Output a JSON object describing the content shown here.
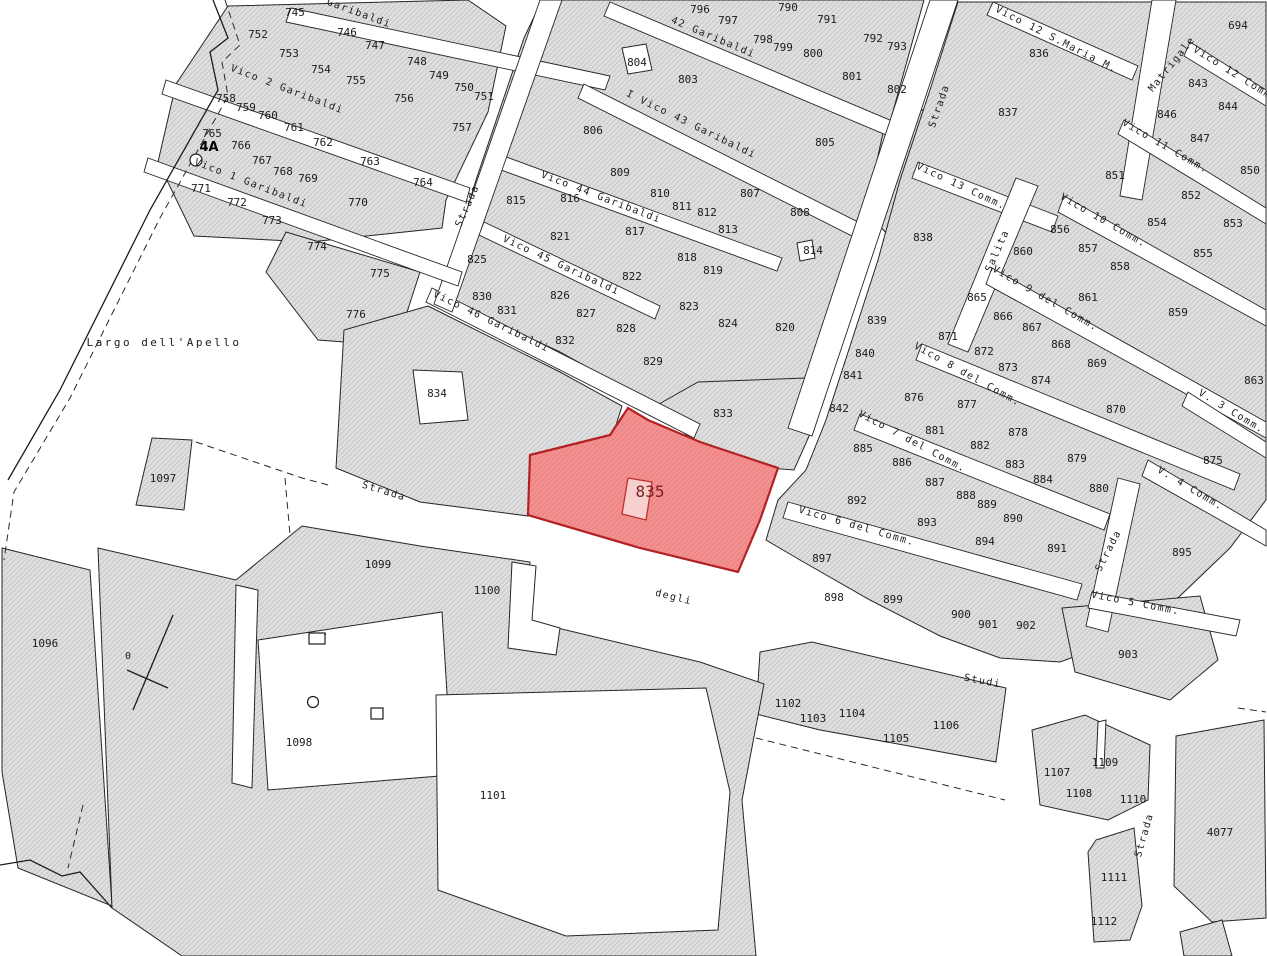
{
  "map": {
    "title": "cadastral-parcel-map",
    "highlighted_parcel": "835",
    "colors": {
      "background": "#ffffff",
      "parcel_fill": "#e0e0e0",
      "parcel_hatch_line": "#c6c6c6",
      "parcel_stroke": "#262626",
      "highlight_fill": "#f28585",
      "highlight_hatch_line": "#ee9d9d",
      "highlight_stroke": "#b22222",
      "highlight_label": "#7e1f1f",
      "label_color": "#1c1c1c"
    }
  },
  "parcels": [
    {
      "n": "745",
      "x": 295,
      "y": 12
    },
    {
      "n": "746",
      "x": 347,
      "y": 32
    },
    {
      "n": "747",
      "x": 375,
      "y": 45
    },
    {
      "n": "748",
      "x": 417,
      "y": 61
    },
    {
      "n": "749",
      "x": 439,
      "y": 75
    },
    {
      "n": "750",
      "x": 464,
      "y": 87
    },
    {
      "n": "751",
      "x": 484,
      "y": 96
    },
    {
      "n": "752",
      "x": 258,
      "y": 34
    },
    {
      "n": "753",
      "x": 289,
      "y": 53
    },
    {
      "n": "754",
      "x": 321,
      "y": 69
    },
    {
      "n": "755",
      "x": 356,
      "y": 80
    },
    {
      "n": "756",
      "x": 404,
      "y": 98
    },
    {
      "n": "757",
      "x": 462,
      "y": 127
    },
    {
      "n": "758",
      "x": 226,
      "y": 98
    },
    {
      "n": "759",
      "x": 246,
      "y": 107
    },
    {
      "n": "760",
      "x": 268,
      "y": 115
    },
    {
      "n": "761",
      "x": 294,
      "y": 127
    },
    {
      "n": "762",
      "x": 323,
      "y": 142
    },
    {
      "n": "763",
      "x": 370,
      "y": 161
    },
    {
      "n": "764",
      "x": 423,
      "y": 182
    },
    {
      "n": "765",
      "x": 212,
      "y": 133
    },
    {
      "n": "766",
      "x": 241,
      "y": 145
    },
    {
      "n": "767",
      "x": 262,
      "y": 160
    },
    {
      "n": "768",
      "x": 283,
      "y": 171
    },
    {
      "n": "769",
      "x": 308,
      "y": 178
    },
    {
      "n": "770",
      "x": 358,
      "y": 202
    },
    {
      "n": "771",
      "x": 201,
      "y": 188
    },
    {
      "n": "772",
      "x": 237,
      "y": 202
    },
    {
      "n": "773",
      "x": 272,
      "y": 220
    },
    {
      "n": "774",
      "x": 317,
      "y": 246
    },
    {
      "n": "775",
      "x": 380,
      "y": 273
    },
    {
      "n": "776",
      "x": 356,
      "y": 314
    },
    {
      "n": "790",
      "x": 788,
      "y": 7
    },
    {
      "n": "791",
      "x": 827,
      "y": 19
    },
    {
      "n": "792",
      "x": 873,
      "y": 38
    },
    {
      "n": "793",
      "x": 897,
      "y": 46
    },
    {
      "n": "796",
      "x": 700,
      "y": 9
    },
    {
      "n": "797",
      "x": 728,
      "y": 20
    },
    {
      "n": "798",
      "x": 763,
      "y": 39
    },
    {
      "n": "799",
      "x": 783,
      "y": 47
    },
    {
      "n": "800",
      "x": 813,
      "y": 53
    },
    {
      "n": "801",
      "x": 852,
      "y": 76
    },
    {
      "n": "802",
      "x": 897,
      "y": 89
    },
    {
      "n": "803",
      "x": 688,
      "y": 79
    },
    {
      "n": "804",
      "x": 637,
      "y": 62
    },
    {
      "n": "805",
      "x": 825,
      "y": 142
    },
    {
      "n": "806",
      "x": 593,
      "y": 130
    },
    {
      "n": "807",
      "x": 750,
      "y": 193
    },
    {
      "n": "808",
      "x": 800,
      "y": 212
    },
    {
      "n": "809",
      "x": 620,
      "y": 172
    },
    {
      "n": "810",
      "x": 660,
      "y": 193
    },
    {
      "n": "811",
      "x": 682,
      "y": 206
    },
    {
      "n": "812",
      "x": 707,
      "y": 212
    },
    {
      "n": "813",
      "x": 728,
      "y": 229
    },
    {
      "n": "814",
      "x": 813,
      "y": 250
    },
    {
      "n": "815",
      "x": 516,
      "y": 200
    },
    {
      "n": "816",
      "x": 570,
      "y": 198
    },
    {
      "n": "817",
      "x": 635,
      "y": 231
    },
    {
      "n": "818",
      "x": 687,
      "y": 257
    },
    {
      "n": "819",
      "x": 713,
      "y": 270
    },
    {
      "n": "820",
      "x": 785,
      "y": 327
    },
    {
      "n": "821",
      "x": 560,
      "y": 236
    },
    {
      "n": "822",
      "x": 632,
      "y": 276
    },
    {
      "n": "823",
      "x": 689,
      "y": 306
    },
    {
      "n": "824",
      "x": 728,
      "y": 323
    },
    {
      "n": "825",
      "x": 477,
      "y": 259
    },
    {
      "n": "826",
      "x": 560,
      "y": 295
    },
    {
      "n": "827",
      "x": 586,
      "y": 313
    },
    {
      "n": "828",
      "x": 626,
      "y": 328
    },
    {
      "n": "829",
      "x": 653,
      "y": 361
    },
    {
      "n": "830",
      "x": 482,
      "y": 296
    },
    {
      "n": "831",
      "x": 507,
      "y": 310
    },
    {
      "n": "832",
      "x": 565,
      "y": 340
    },
    {
      "n": "833",
      "x": 723,
      "y": 413
    },
    {
      "n": "834",
      "x": 437,
      "y": 393
    },
    {
      "n": "836",
      "x": 1039,
      "y": 53
    },
    {
      "n": "837",
      "x": 1008,
      "y": 112
    },
    {
      "n": "838",
      "x": 923,
      "y": 237
    },
    {
      "n": "839",
      "x": 877,
      "y": 320
    },
    {
      "n": "840",
      "x": 865,
      "y": 353
    },
    {
      "n": "841",
      "x": 853,
      "y": 375
    },
    {
      "n": "842",
      "x": 839,
      "y": 408
    },
    {
      "n": "843",
      "x": 1198,
      "y": 83
    },
    {
      "n": "844",
      "x": 1228,
      "y": 106
    },
    {
      "n": "846",
      "x": 1167,
      "y": 114
    },
    {
      "n": "847",
      "x": 1200,
      "y": 138
    },
    {
      "n": "850",
      "x": 1250,
      "y": 170
    },
    {
      "n": "851",
      "x": 1115,
      "y": 175
    },
    {
      "n": "852",
      "x": 1191,
      "y": 195
    },
    {
      "n": "853",
      "x": 1233,
      "y": 223
    },
    {
      "n": "854",
      "x": 1157,
      "y": 222
    },
    {
      "n": "855",
      "x": 1203,
      "y": 253
    },
    {
      "n": "856",
      "x": 1060,
      "y": 229
    },
    {
      "n": "857",
      "x": 1088,
      "y": 248
    },
    {
      "n": "858",
      "x": 1120,
      "y": 266
    },
    {
      "n": "859",
      "x": 1178,
      "y": 312
    },
    {
      "n": "860",
      "x": 1023,
      "y": 251
    },
    {
      "n": "861",
      "x": 1088,
      "y": 297
    },
    {
      "n": "863",
      "x": 1254,
      "y": 380
    },
    {
      "n": "865",
      "x": 977,
      "y": 297
    },
    {
      "n": "866",
      "x": 1003,
      "y": 316
    },
    {
      "n": "867",
      "x": 1032,
      "y": 327
    },
    {
      "n": "868",
      "x": 1061,
      "y": 344
    },
    {
      "n": "869",
      "x": 1097,
      "y": 363
    },
    {
      "n": "870",
      "x": 1116,
      "y": 409
    },
    {
      "n": "871",
      "x": 948,
      "y": 336
    },
    {
      "n": "872",
      "x": 984,
      "y": 351
    },
    {
      "n": "873",
      "x": 1008,
      "y": 367
    },
    {
      "n": "874",
      "x": 1041,
      "y": 380
    },
    {
      "n": "875",
      "x": 1213,
      "y": 460
    },
    {
      "n": "876",
      "x": 914,
      "y": 397
    },
    {
      "n": "877",
      "x": 967,
      "y": 404
    },
    {
      "n": "878",
      "x": 1018,
      "y": 432
    },
    {
      "n": "879",
      "x": 1077,
      "y": 458
    },
    {
      "n": "880",
      "x": 1099,
      "y": 488
    },
    {
      "n": "881",
      "x": 935,
      "y": 430
    },
    {
      "n": "882",
      "x": 980,
      "y": 445
    },
    {
      "n": "883",
      "x": 1015,
      "y": 464
    },
    {
      "n": "884",
      "x": 1043,
      "y": 479
    },
    {
      "n": "885",
      "x": 863,
      "y": 448
    },
    {
      "n": "886",
      "x": 902,
      "y": 462
    },
    {
      "n": "887",
      "x": 935,
      "y": 482
    },
    {
      "n": "888",
      "x": 966,
      "y": 495
    },
    {
      "n": "889",
      "x": 987,
      "y": 504
    },
    {
      "n": "890",
      "x": 1013,
      "y": 518
    },
    {
      "n": "891",
      "x": 1057,
      "y": 548
    },
    {
      "n": "892",
      "x": 857,
      "y": 500
    },
    {
      "n": "893",
      "x": 927,
      "y": 522
    },
    {
      "n": "894",
      "x": 985,
      "y": 541
    },
    {
      "n": "895",
      "x": 1182,
      "y": 552
    },
    {
      "n": "897",
      "x": 822,
      "y": 558
    },
    {
      "n": "898",
      "x": 834,
      "y": 597
    },
    {
      "n": "899",
      "x": 893,
      "y": 599
    },
    {
      "n": "900",
      "x": 961,
      "y": 614
    },
    {
      "n": "901",
      "x": 988,
      "y": 624
    },
    {
      "n": "902",
      "x": 1026,
      "y": 625
    },
    {
      "n": "903",
      "x": 1128,
      "y": 654
    },
    {
      "n": "694",
      "x": 1238,
      "y": 25
    },
    {
      "n": "1096",
      "x": 45,
      "y": 643
    },
    {
      "n": "1097",
      "x": 163,
      "y": 478
    },
    {
      "n": "1098",
      "x": 299,
      "y": 742
    },
    {
      "n": "1099",
      "x": 378,
      "y": 564
    },
    {
      "n": "1100",
      "x": 487,
      "y": 590
    },
    {
      "n": "1101",
      "x": 493,
      "y": 795
    },
    {
      "n": "1102",
      "x": 788,
      "y": 703
    },
    {
      "n": "1103",
      "x": 813,
      "y": 718
    },
    {
      "n": "1104",
      "x": 852,
      "y": 713
    },
    {
      "n": "1105",
      "x": 896,
      "y": 738
    },
    {
      "n": "1106",
      "x": 946,
      "y": 725
    },
    {
      "n": "1107",
      "x": 1057,
      "y": 772
    },
    {
      "n": "1108",
      "x": 1079,
      "y": 793
    },
    {
      "n": "1109",
      "x": 1105,
      "y": 762
    },
    {
      "n": "1110",
      "x": 1133,
      "y": 799
    },
    {
      "n": "1111",
      "x": 1114,
      "y": 877
    },
    {
      "n": "1112",
      "x": 1104,
      "y": 921
    },
    {
      "n": "4077",
      "x": 1220,
      "y": 832
    }
  ],
  "highlight_label": {
    "n": "835",
    "x": 650,
    "y": 497
  },
  "street_labels": [
    {
      "t": "Garibaldi",
      "x": 358,
      "y": 16,
      "a": 20
    },
    {
      "t": "Vico 2 Garibaldi",
      "x": 286,
      "y": 92,
      "a": 21
    },
    {
      "t": "Vico 1 Garibaldi",
      "x": 250,
      "y": 186,
      "a": 21
    },
    {
      "t": "Strada",
      "x": 470,
      "y": 207,
      "a": -66
    },
    {
      "t": "42  Garibaldi",
      "x": 712,
      "y": 40,
      "a": 23
    },
    {
      "t": "I Vico 43 Garibaldi",
      "x": 690,
      "y": 127,
      "a": 26
    },
    {
      "t": "Vico 44 Garibaldi",
      "x": 600,
      "y": 200,
      "a": 21
    },
    {
      "t": "Vico 45 Garibaldi",
      "x": 560,
      "y": 268,
      "a": 25
    },
    {
      "t": "Vico 46 Garibaldi",
      "x": 490,
      "y": 324,
      "a": 26
    },
    {
      "t": "Strada",
      "x": 383,
      "y": 494,
      "a": 17
    },
    {
      "t": "degli",
      "x": 673,
      "y": 600,
      "a": 14
    },
    {
      "t": "Studi",
      "x": 982,
      "y": 684,
      "a": 11
    },
    {
      "t": "Vico 12 S.Maria M.",
      "x": 1055,
      "y": 42,
      "a": 27
    },
    {
      "t": "Matrigale",
      "x": 1174,
      "y": 66,
      "a": -51
    },
    {
      "t": "Vico 12 Comm.",
      "x": 1234,
      "y": 77,
      "a": 32
    },
    {
      "t": "Vico 11 Comm.",
      "x": 1164,
      "y": 149,
      "a": 30
    },
    {
      "t": "Vico 13 Comm.",
      "x": 960,
      "y": 189,
      "a": 25
    },
    {
      "t": "Vico 10 Comm.",
      "x": 1102,
      "y": 223,
      "a": 30
    },
    {
      "t": "Strada",
      "x": 942,
      "y": 107,
      "a": -71
    },
    {
      "t": "Salita",
      "x": 1000,
      "y": 252,
      "a": -66
    },
    {
      "t": "Vico 9 del Comm.",
      "x": 1044,
      "y": 301,
      "a": 30
    },
    {
      "t": "Vico 8 del Comm.",
      "x": 966,
      "y": 377,
      "a": 29
    },
    {
      "t": "Vico 7 del Comm.",
      "x": 911,
      "y": 444,
      "a": 28
    },
    {
      "t": "Vico 6 del Comm.",
      "x": 856,
      "y": 529,
      "a": 16
    },
    {
      "t": "V. 3 Comm.",
      "x": 1230,
      "y": 414,
      "a": 31
    },
    {
      "t": "V. 4 Comm.",
      "x": 1189,
      "y": 491,
      "a": 31
    },
    {
      "t": "Strada",
      "x": 1111,
      "y": 552,
      "a": -63
    },
    {
      "t": "Vico 5 Comm.",
      "x": 1135,
      "y": 606,
      "a": 11
    },
    {
      "t": "Strada",
      "x": 1147,
      "y": 836,
      "a": -74
    }
  ],
  "place_labels": [
    {
      "t": "Largo dell'Apello",
      "x": 164,
      "y": 346,
      "cls": "place"
    },
    {
      "t": "4A",
      "x": 209,
      "y": 151,
      "cls": "marker"
    },
    {
      "t": "0",
      "x": 128,
      "y": 659,
      "cls": "tiny"
    }
  ],
  "geometry": {
    "blocks": [
      "228,6 468,0 506,26 488,112 446,200 442,228 310,242 194,236 158,162 176,84",
      "286,232 420,272 396,346 318,340 266,272",
      "542,0 924,0 806,424 778,454 700,430 560,352 444,298 458,240 476,180 524,38",
      "428,306 560,372 622,406 612,438 532,458 528,516 420,502 336,468 344,330",
      "652,408 698,382 806,378 818,416 794,470 742,466 688,436",
      "884,128 952,96 1002,200 988,262 920,268 866,212",
      "958,2 1266,2 1266,500 1230,548 1180,596 1120,640 1060,662 1000,658 940,636 870,600 800,560 766,540 778,500 806,470 826,420 852,340 878,260 900,180 930,90",
      "1062,608 1200,596 1218,660 1170,700 1075,672",
      "1032,730 1085,715 1150,745 1148,800 1108,820 1040,805",
      "1096,840 1134,828 1142,906 1130,940 1094,942 1088,852",
      "1176,736 1264,720 1266,918 1212,922 1174,886",
      "1180,932 1222,920 1232,956 1184,956",
      "760,652 812,642 1006,688 996,762 898,744 820,730 756,714",
      "2,548 90,570 112,906 18,868 2,772",
      "152,438 192,440 184,510 136,505",
      "98,548 236,580 302,526 420,546 530,562 524,620 700,662 764,684 742,800 756,956 182,956 112,908"
    ],
    "holes": [
      "258,640 442,612 452,775 268,790",
      "236,585 258,590 252,788 232,783",
      "512,562 536,566 532,620 560,628 556,655 508,648",
      "436,695 706,688 730,792 718,930 566,936 438,890",
      "413,370 462,372 468,420 420,424",
      "622,48 646,44 652,70 628,74",
      "797,243 812,240 815,258 800,261",
      "1098,722 1106,720 1104,768 1096,768"
    ],
    "streets": [
      "291,8 610,76 605,90 286,22",
      "610,2 904,126 898,140 604,16",
      "584,84 862,224 856,238 578,98",
      "498,154 782,258 777,271 493,167",
      "484,222 660,306 655,319 479,235",
      "432,288 700,424 694,438 426,302",
      "540,0 562,0 452,312 434,304",
      "166,80 470,188 466,202 162,94",
      "148,158 462,272 458,286 144,172",
      "930,0 958,0 812,436 788,428",
      "993,2 1138,66 1132,80 987,15",
      "1152,0 1176,0 1142,200 1120,196",
      "1190,42 1266,90 1266,106 1184,56",
      "1124,120 1266,208 1266,224 1118,134",
      "918,162 1058,216 1052,232 912,178",
      "1064,196 1266,310 1266,326 1058,212",
      "1016,178 1038,186 968,352 948,344",
      "992,268 1266,422 1266,438 986,284",
      "922,344 1240,474 1234,490 916,360",
      "860,414 1110,514 1104,530 854,430",
      "1188,392 1266,442 1266,458 1182,406",
      "1148,460 1266,530 1266,546 1142,476",
      "1118,478 1140,484 1108,632 1086,626",
      "788,502 1082,584 1077,600 783,518",
      "1092,592 1240,620 1236,636 1088,608"
    ],
    "highlight": "530,455 610,435 628,408 648,420 700,442 778,468 760,520 738,572 640,548 528,515",
    "highlight_inner": "628,478 652,482 646,520 622,514",
    "lines_solid": [
      "213,0 228,38 210,52 218,90 150,210 60,390 8,480",
      "127,670 168,688",
      "173,615 133,710",
      "0,865 30,860 62,876 80,872 112,908",
      "310,640 326,634"
    ],
    "lines_dashed": [
      "225,0 240,45 222,62 228,96 160,218 70,398 14,492 4,560",
      "196,442 302,478 332,486",
      "285,478 290,535",
      "83,805 68,868",
      "756,738 1005,800",
      "1238,708 1266,712"
    ],
    "symbols": [
      {
        "t": "circle",
        "x": 196,
        "y": 160,
        "r": 6
      },
      {
        "t": "circle",
        "x": 313,
        "y": 702,
        "r": 5.5
      },
      {
        "t": "rect",
        "x": 371,
        "y": 708,
        "w": 12,
        "h": 11
      },
      {
        "t": "rect",
        "x": 309,
        "y": 633,
        "w": 16,
        "h": 11
      }
    ]
  }
}
